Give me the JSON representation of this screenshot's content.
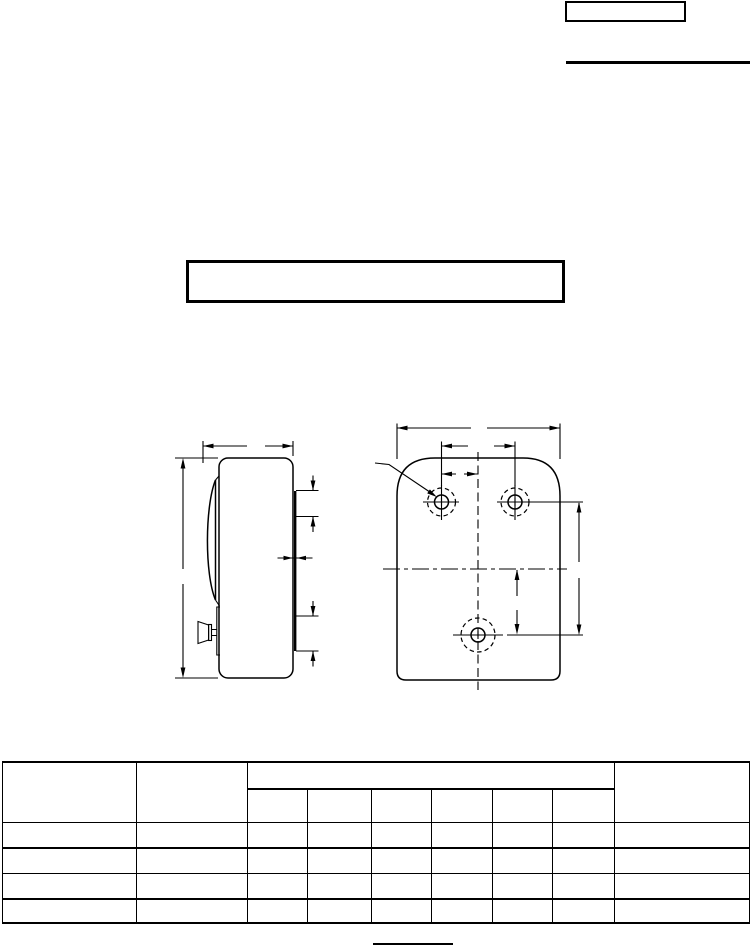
{
  "page": {
    "background": "#ffffff",
    "line_color": "#000000"
  },
  "form": {
    "spec_number_box_text": "",
    "drawing_title_box_text": "",
    "sheet_footer_text": ""
  },
  "table": {
    "header": {
      "col1": "",
      "col2": "",
      "group": "",
      "subcols": [
        "",
        "",
        "",
        "",
        "",
        ""
      ],
      "last": ""
    },
    "rows": [
      [
        "",
        "",
        "",
        "",
        "",
        "",
        "",
        "",
        ""
      ],
      [
        "",
        "",
        "",
        "",
        "",
        "",
        "",
        "",
        ""
      ],
      [
        "",
        "",
        "",
        "",
        "",
        "",
        "",
        "",
        ""
      ],
      [
        "",
        "",
        "",
        "",
        "",
        "",
        "",
        "",
        ""
      ]
    ]
  }
}
